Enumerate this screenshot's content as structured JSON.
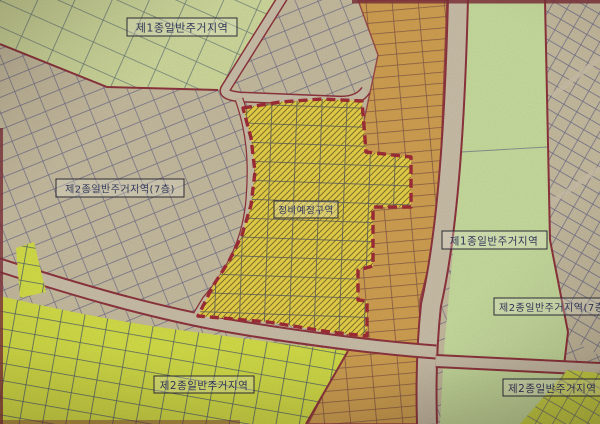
{
  "map": {
    "kind": "korean-zoning-district-map",
    "labels": {
      "topleft": "제1종일반주거지역",
      "midleft": "제2종일반주거지역(7층)",
      "project": "정비예정구역",
      "right_green": "제1종일반주거지역",
      "right_upper": "제2종일반주거지역(7층",
      "right_lower": "제2종일반주거지역",
      "bottomleft": "제2종일반주거지역"
    },
    "colors": {
      "base_beige": "#cbbfa0",
      "pale_green": "#d5e19c",
      "pale_green_band": "#cde59f",
      "bright_green": "#d9e63c",
      "bright_green_corner": "#d5e23c",
      "orange_band": "#d7a148",
      "project_yellow": "#f1d73b",
      "road_tan": "#cfc3aa",
      "boundary_red": "#8e2733",
      "project_boundary_red": "#a11f2b"
    }
  }
}
